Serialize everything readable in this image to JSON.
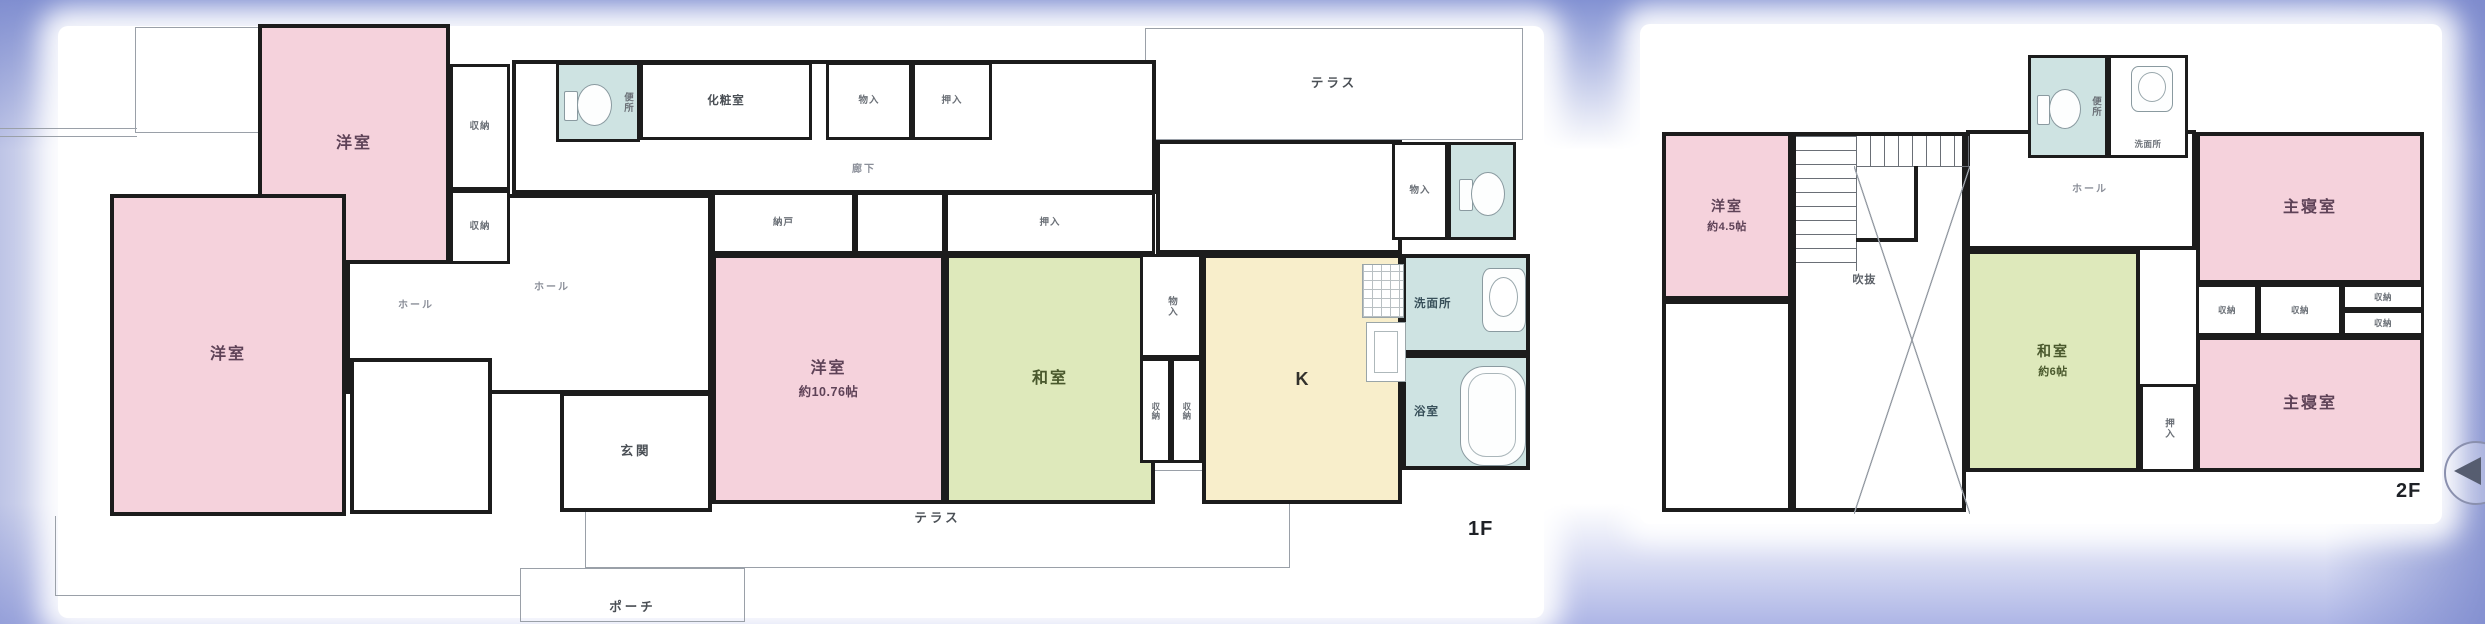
{
  "palette": {
    "background_top": "#8392d3",
    "background_bottom": "#aeb6e6",
    "wall": "#1c1c1c",
    "thin_line": "#9aa0a8",
    "room_pink": "#f5d2dc",
    "room_green": "#dee9bb",
    "room_cream": "#f8eecb",
    "room_teal": "#cee3e2"
  },
  "backdrops": [
    {
      "id": "plan-backdrop-1f",
      "x": 58,
      "y": 26,
      "w": 1486,
      "h": 592
    },
    {
      "id": "plan-backdrop-2f",
      "x": 1640,
      "y": 24,
      "w": 802,
      "h": 500
    }
  ],
  "carousel": {
    "id": "carousel-prev-button",
    "direction": "previous",
    "x": 2444,
    "y": 441,
    "w": 60,
    "h": 60
  },
  "floors": [
    {
      "id": "1f",
      "floor_label": "1F",
      "rooms": [
        {
          "id": "terrace-top",
          "label": "テラス",
          "x": 1145,
          "y": 28,
          "w": 378,
          "h": 112,
          "fill": "none",
          "border": "thin",
          "cls": "t-label"
        },
        {
          "id": "eave-outline-top-left",
          "label": "",
          "x": 135,
          "y": 27,
          "w": 123,
          "h": 106,
          "fill": "none",
          "border": "thinl"
        },
        {
          "id": "eave-outline-left",
          "label": "",
          "x": 0,
          "y": 128,
          "w": 137,
          "h": 9,
          "fill": "none",
          "border": "thintb"
        },
        {
          "id": "eave-outline-bottom-left",
          "label": "",
          "x": 55,
          "y": 516,
          "w": 465,
          "h": 80,
          "fill": "none",
          "border": "thinlb"
        },
        {
          "id": "porch",
          "label": "ポーチ",
          "x": 520,
          "y": 568,
          "w": 225,
          "h": 54,
          "fill": "none",
          "border": "thin",
          "cls": "t-label lbl-bottom"
        },
        {
          "id": "terrace-bottom",
          "label": "テラス",
          "x": 585,
          "y": 470,
          "w": 705,
          "h": 98,
          "fill": "none",
          "border": "thin",
          "cls": "t-label"
        },
        {
          "id": "corridor",
          "label": "",
          "x": 512,
          "y": 60,
          "w": 644,
          "h": 134,
          "fill": "white",
          "border": "wall"
        },
        {
          "id": "upper-hall-right",
          "label": "",
          "x": 1156,
          "y": 140,
          "w": 246,
          "h": 114,
          "fill": "white",
          "border": "wall"
        },
        {
          "id": "hall",
          "label": "",
          "x": 346,
          "y": 194,
          "w": 366,
          "h": 200,
          "fill": "white",
          "border": "wall"
        },
        {
          "id": "storage-room",
          "label": "",
          "x": 350,
          "y": 358,
          "w": 142,
          "h": 156,
          "fill": "white",
          "border": "wall"
        },
        {
          "id": "genkan",
          "label": "玄関",
          "x": 560,
          "y": 392,
          "w": 152,
          "h": 120,
          "fill": "white",
          "border": "wall",
          "cls": "t-label"
        },
        {
          "id": "yoshitsu-upper",
          "label": "洋室",
          "x": 258,
          "y": 24,
          "w": 192,
          "h": 240,
          "fill": "pink",
          "border": "wall"
        },
        {
          "id": "yoshitsu-big",
          "label": "洋室",
          "x": 110,
          "y": 194,
          "w": 236,
          "h": 322,
          "fill": "pink",
          "border": "wall"
        },
        {
          "id": "closet-upper-a",
          "label": "収納",
          "x": 450,
          "y": 64,
          "w": 60,
          "h": 126,
          "fill": "white",
          "border": "wall3",
          "cls": "s-label"
        },
        {
          "id": "closet-upper-b",
          "label": "収納",
          "x": 450,
          "y": 190,
          "w": 60,
          "h": 74,
          "fill": "white",
          "border": "wall3",
          "cls": "s-label"
        },
        {
          "id": "benjo-1f",
          "label": "便所",
          "x": 556,
          "y": 62,
          "w": 84,
          "h": 80,
          "fill": "teal",
          "border": "wall3",
          "cls": "s-label lbl-right",
          "vert": true,
          "icons": [
            {
              "t": "toilet",
              "x": 5,
              "y": 16,
              "w": 50,
              "h": 48
            }
          ]
        },
        {
          "id": "keshoshitsu",
          "label": "化粧室",
          "x": 640,
          "y": 62,
          "w": 172,
          "h": 78,
          "fill": "white",
          "border": "wall3",
          "cls": "m-label"
        },
        {
          "id": "closet-corridor-a",
          "label": "物入",
          "x": 826,
          "y": 62,
          "w": 86,
          "h": 78,
          "fill": "white",
          "border": "wall3",
          "cls": "s-label"
        },
        {
          "id": "closet-corridor-b",
          "label": "押入",
          "x": 912,
          "y": 62,
          "w": 80,
          "h": 78,
          "fill": "white",
          "border": "wall3",
          "cls": "s-label"
        },
        {
          "id": "nando",
          "label": "納戸",
          "x": 712,
          "y": 192,
          "w": 143,
          "h": 62,
          "fill": "white",
          "border": "wall3",
          "cls": "s-label"
        },
        {
          "id": "closet-mid",
          "label": "",
          "x": 855,
          "y": 192,
          "w": 90,
          "h": 62,
          "fill": "white",
          "border": "wall3"
        },
        {
          "id": "oshiire-1f",
          "label": "押入",
          "x": 945,
          "y": 192,
          "w": 210,
          "h": 62,
          "fill": "white",
          "border": "wall3",
          "cls": "s-label"
        },
        {
          "id": "yoshitsu-main",
          "label": "洋室",
          "sub": "約10.76帖",
          "x": 712,
          "y": 254,
          "w": 233,
          "h": 250,
          "fill": "pink",
          "border": "wall"
        },
        {
          "id": "washitsu-1f",
          "label": "和室",
          "x": 945,
          "y": 254,
          "w": 210,
          "h": 250,
          "fill": "green",
          "border": "wall"
        },
        {
          "id": "monoire-mid",
          "label": "物入",
          "x": 1140,
          "y": 254,
          "w": 62,
          "h": 104,
          "fill": "white",
          "border": "wall3",
          "cls": "s-label",
          "vert": true
        },
        {
          "id": "shuno-mid-a",
          "label": "収納",
          "x": 1140,
          "y": 358,
          "w": 31,
          "h": 105,
          "fill": "white",
          "border": "wall3",
          "cls": "xs-label",
          "vert": true
        },
        {
          "id": "shuno-mid-b",
          "label": "収納",
          "x": 1171,
          "y": 358,
          "w": 31,
          "h": 105,
          "fill": "white",
          "border": "wall3",
          "cls": "xs-label",
          "vert": true
        },
        {
          "id": "kitchen",
          "label": "K",
          "x": 1202,
          "y": 254,
          "w": 200,
          "h": 250,
          "fill": "cream",
          "border": "wall",
          "cls": "k-label",
          "icons": [
            {
              "t": "stove",
              "x": 156,
              "y": 6,
              "w": 40,
              "h": 52
            },
            {
              "t": "ksink",
              "x": 160,
              "y": 64,
              "w": 38,
              "h": 58
            }
          ]
        },
        {
          "id": "monoire-ne",
          "label": "物入",
          "x": 1392,
          "y": 142,
          "w": 56,
          "h": 98,
          "fill": "white",
          "border": "wall3",
          "cls": "s-label"
        },
        {
          "id": "benjo-1f-b",
          "label": "",
          "x": 1448,
          "y": 142,
          "w": 68,
          "h": 98,
          "fill": "teal",
          "border": "wall3",
          "icons": [
            {
              "t": "toilet",
              "x": 8,
              "y": 24,
              "w": 48,
              "h": 50
            }
          ]
        },
        {
          "id": "senmenjo-1f",
          "label": "洗面所",
          "x": 1402,
          "y": 254,
          "w": 128,
          "h": 100,
          "fill": "teal",
          "border": "wall",
          "cls": "m-label lbl-left",
          "icons": [
            {
              "t": "sink",
              "x": 76,
              "y": 10,
              "w": 44,
              "h": 64
            }
          ]
        },
        {
          "id": "yokushitsu",
          "label": "浴室",
          "x": 1402,
          "y": 354,
          "w": 128,
          "h": 116,
          "fill": "teal",
          "border": "wall",
          "cls": "m-label lbl-left",
          "icons": [
            {
              "t": "tub",
              "x": 54,
              "y": 8,
              "w": 66,
              "h": 100
            }
          ]
        }
      ],
      "annotations": [
        {
          "text": "廊下",
          "x": 852,
          "y": 160,
          "cls": "gray"
        },
        {
          "text": "ホール",
          "x": 398,
          "y": 296,
          "cls": "gray"
        },
        {
          "text": "ホール",
          "x": 534,
          "y": 278,
          "cls": "gray"
        },
        {
          "text": "1F",
          "x": 1468,
          "y": 518,
          "cls": "floor"
        }
      ]
    },
    {
      "id": "2f",
      "floor_label": "2F",
      "rooms": [
        {
          "id": "yoshitsu-45",
          "label": "洋室",
          "sub": "約4.5帖",
          "x": 1662,
          "y": 132,
          "w": 130,
          "h": 168,
          "fill": "pink",
          "border": "wall",
          "cls": "sm-room"
        },
        {
          "id": "room-sw-2f",
          "label": "",
          "x": 1662,
          "y": 300,
          "w": 130,
          "h": 212,
          "fill": "white",
          "border": "wall"
        },
        {
          "id": "stair-void",
          "label": "吹抜",
          "x": 1792,
          "y": 132,
          "w": 174,
          "h": 380,
          "fill": "white",
          "border": "wall",
          "cls": "void-label",
          "icons": [
            {
              "t": "stairs-v",
              "x": 60,
              "y": 0,
              "w": 114,
              "h": 30
            },
            {
              "t": "stairs-h",
              "x": 0,
              "y": 0,
              "w": 60,
              "h": 135
            },
            {
              "t": "stair-wall",
              "x": 60,
              "y": 30,
              "w": 58,
              "h": 72
            },
            {
              "t": "void-x",
              "x": 58,
              "y": 30,
              "w": 116,
              "h": 348
            }
          ]
        },
        {
          "id": "hall-2f",
          "label": "",
          "x": 1966,
          "y": 130,
          "w": 230,
          "h": 120,
          "fill": "white",
          "border": "wall"
        },
        {
          "id": "benjo-2f",
          "label": "便所",
          "x": 2028,
          "y": 55,
          "w": 80,
          "h": 103,
          "fill": "teal",
          "border": "wall3",
          "cls": "s-label lbl-right",
          "vert": true,
          "icons": [
            {
              "t": "toilet",
              "x": 6,
              "y": 28,
              "w": 46,
              "h": 46
            }
          ]
        },
        {
          "id": "senmenjo-2f",
          "label": "洗面所",
          "x": 2108,
          "y": 55,
          "w": 80,
          "h": 103,
          "fill": "white",
          "border": "wall3",
          "cls": "xs-label lbl-bottom",
          "icons": [
            {
              "t": "sink",
              "x": 20,
              "y": 8,
              "w": 42,
              "h": 46
            }
          ]
        },
        {
          "id": "shushinshitsu-1",
          "label": "主寝室",
          "x": 2196,
          "y": 132,
          "w": 228,
          "h": 152,
          "fill": "pink",
          "border": "wall"
        },
        {
          "id": "closet-2f-a",
          "label": "収納",
          "x": 2196,
          "y": 284,
          "w": 62,
          "h": 52,
          "fill": "white",
          "border": "wall3",
          "cls": "xs-label"
        },
        {
          "id": "closet-2f-b",
          "label": "収納",
          "x": 2258,
          "y": 284,
          "w": 84,
          "h": 52,
          "fill": "white",
          "border": "wall3",
          "cls": "xs-label"
        },
        {
          "id": "closet-2f-c",
          "label": "収納",
          "x": 2342,
          "y": 284,
          "w": 82,
          "h": 26,
          "fill": "white",
          "border": "wall3",
          "cls": "xs-label"
        },
        {
          "id": "closet-2f-d",
          "label": "収納",
          "x": 2342,
          "y": 310,
          "w": 82,
          "h": 26,
          "fill": "white",
          "border": "wall3",
          "cls": "xs-label"
        },
        {
          "id": "shushinshitsu-2",
          "label": "主寝室",
          "x": 2196,
          "y": 336,
          "w": 228,
          "h": 136,
          "fill": "pink",
          "border": "wall"
        },
        {
          "id": "oshiire-2f",
          "label": "押入",
          "x": 2140,
          "y": 384,
          "w": 56,
          "h": 88,
          "fill": "white",
          "border": "wall3",
          "cls": "s-label",
          "vert": true
        },
        {
          "id": "washitsu-2f",
          "label": "和室",
          "sub": "約6帖",
          "x": 1966,
          "y": 250,
          "w": 174,
          "h": 222,
          "fill": "green",
          "border": "wall",
          "cls": "sm-room"
        }
      ],
      "annotations": [
        {
          "text": "ホール",
          "x": 2072,
          "y": 180,
          "cls": "gray"
        },
        {
          "text": "2F",
          "x": 2396,
          "y": 480,
          "cls": "floor"
        }
      ]
    }
  ]
}
